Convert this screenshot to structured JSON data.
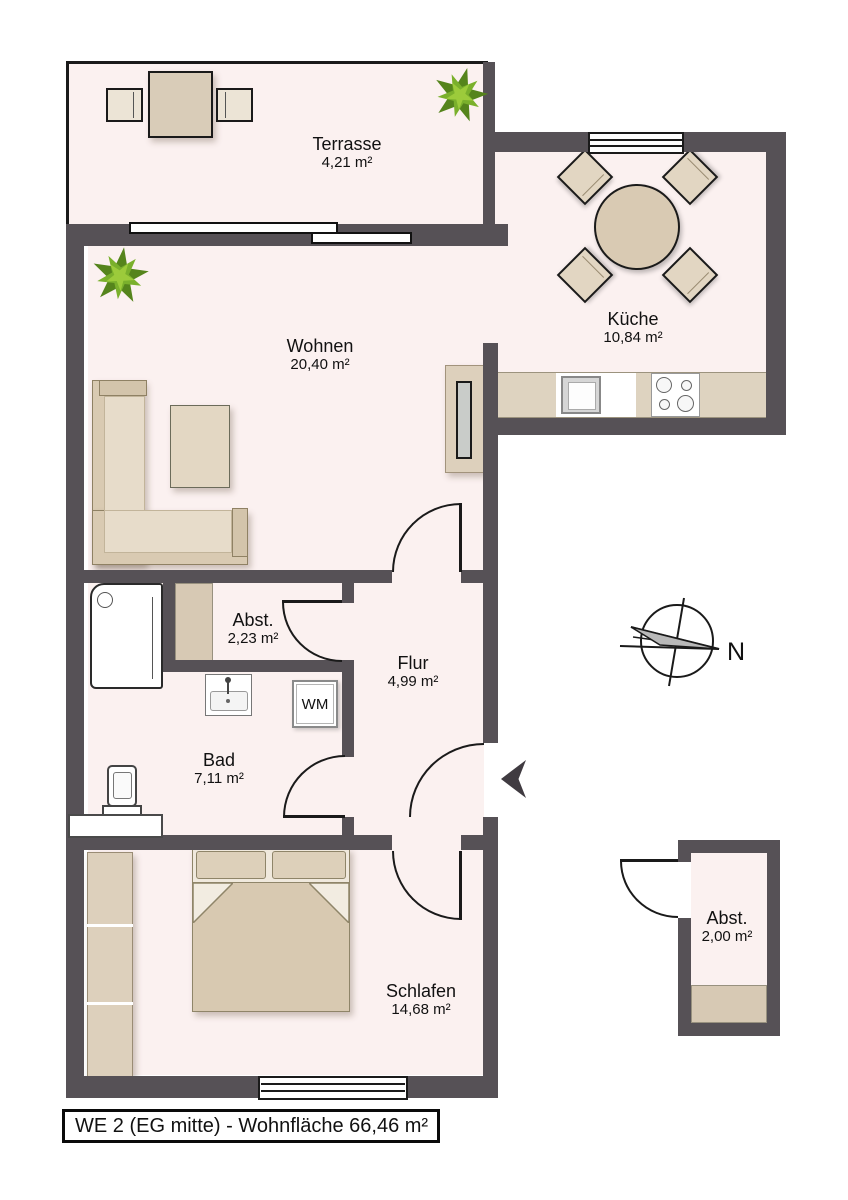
{
  "title_bar": {
    "text": "WE 2 (EG mitte) - Wohnfläche 66,46 m²"
  },
  "compass": {
    "label": "N"
  },
  "rooms": {
    "terrasse": {
      "name": "Terrasse",
      "area": "4,21 m²"
    },
    "kueche": {
      "name": "Küche",
      "area": "10,84 m²"
    },
    "wohnen": {
      "name": "Wohnen",
      "area": "20,40 m²"
    },
    "abstellraum": {
      "name": "Abst.",
      "area": "2,23 m²"
    },
    "flur": {
      "name": "Flur",
      "area": "4,99 m²"
    },
    "bad": {
      "name": "Bad",
      "area": "7,11 m²"
    },
    "schlafen": {
      "name": "Schlafen",
      "area": "14,68 m²"
    },
    "abstellraum_aussen": {
      "name": "Abst.",
      "area": "2,00 m²"
    }
  },
  "fixtures": {
    "washing_machine_label": "WM"
  },
  "icons": {
    "plant": "plant-icon",
    "compass": "compass-rose-icon",
    "entrance_arrow": "entrance-direction-arrow-icon"
  },
  "colors": {
    "wall": "#565156",
    "floor": "#FBF1F0",
    "furniture": "#DDD0BC",
    "furniture_light": "#E7DCCA",
    "counter": "#DED3C0",
    "outline": "#1A1A1A",
    "plant_dark": "#55841C",
    "plant_light": "#9CCB3B"
  }
}
